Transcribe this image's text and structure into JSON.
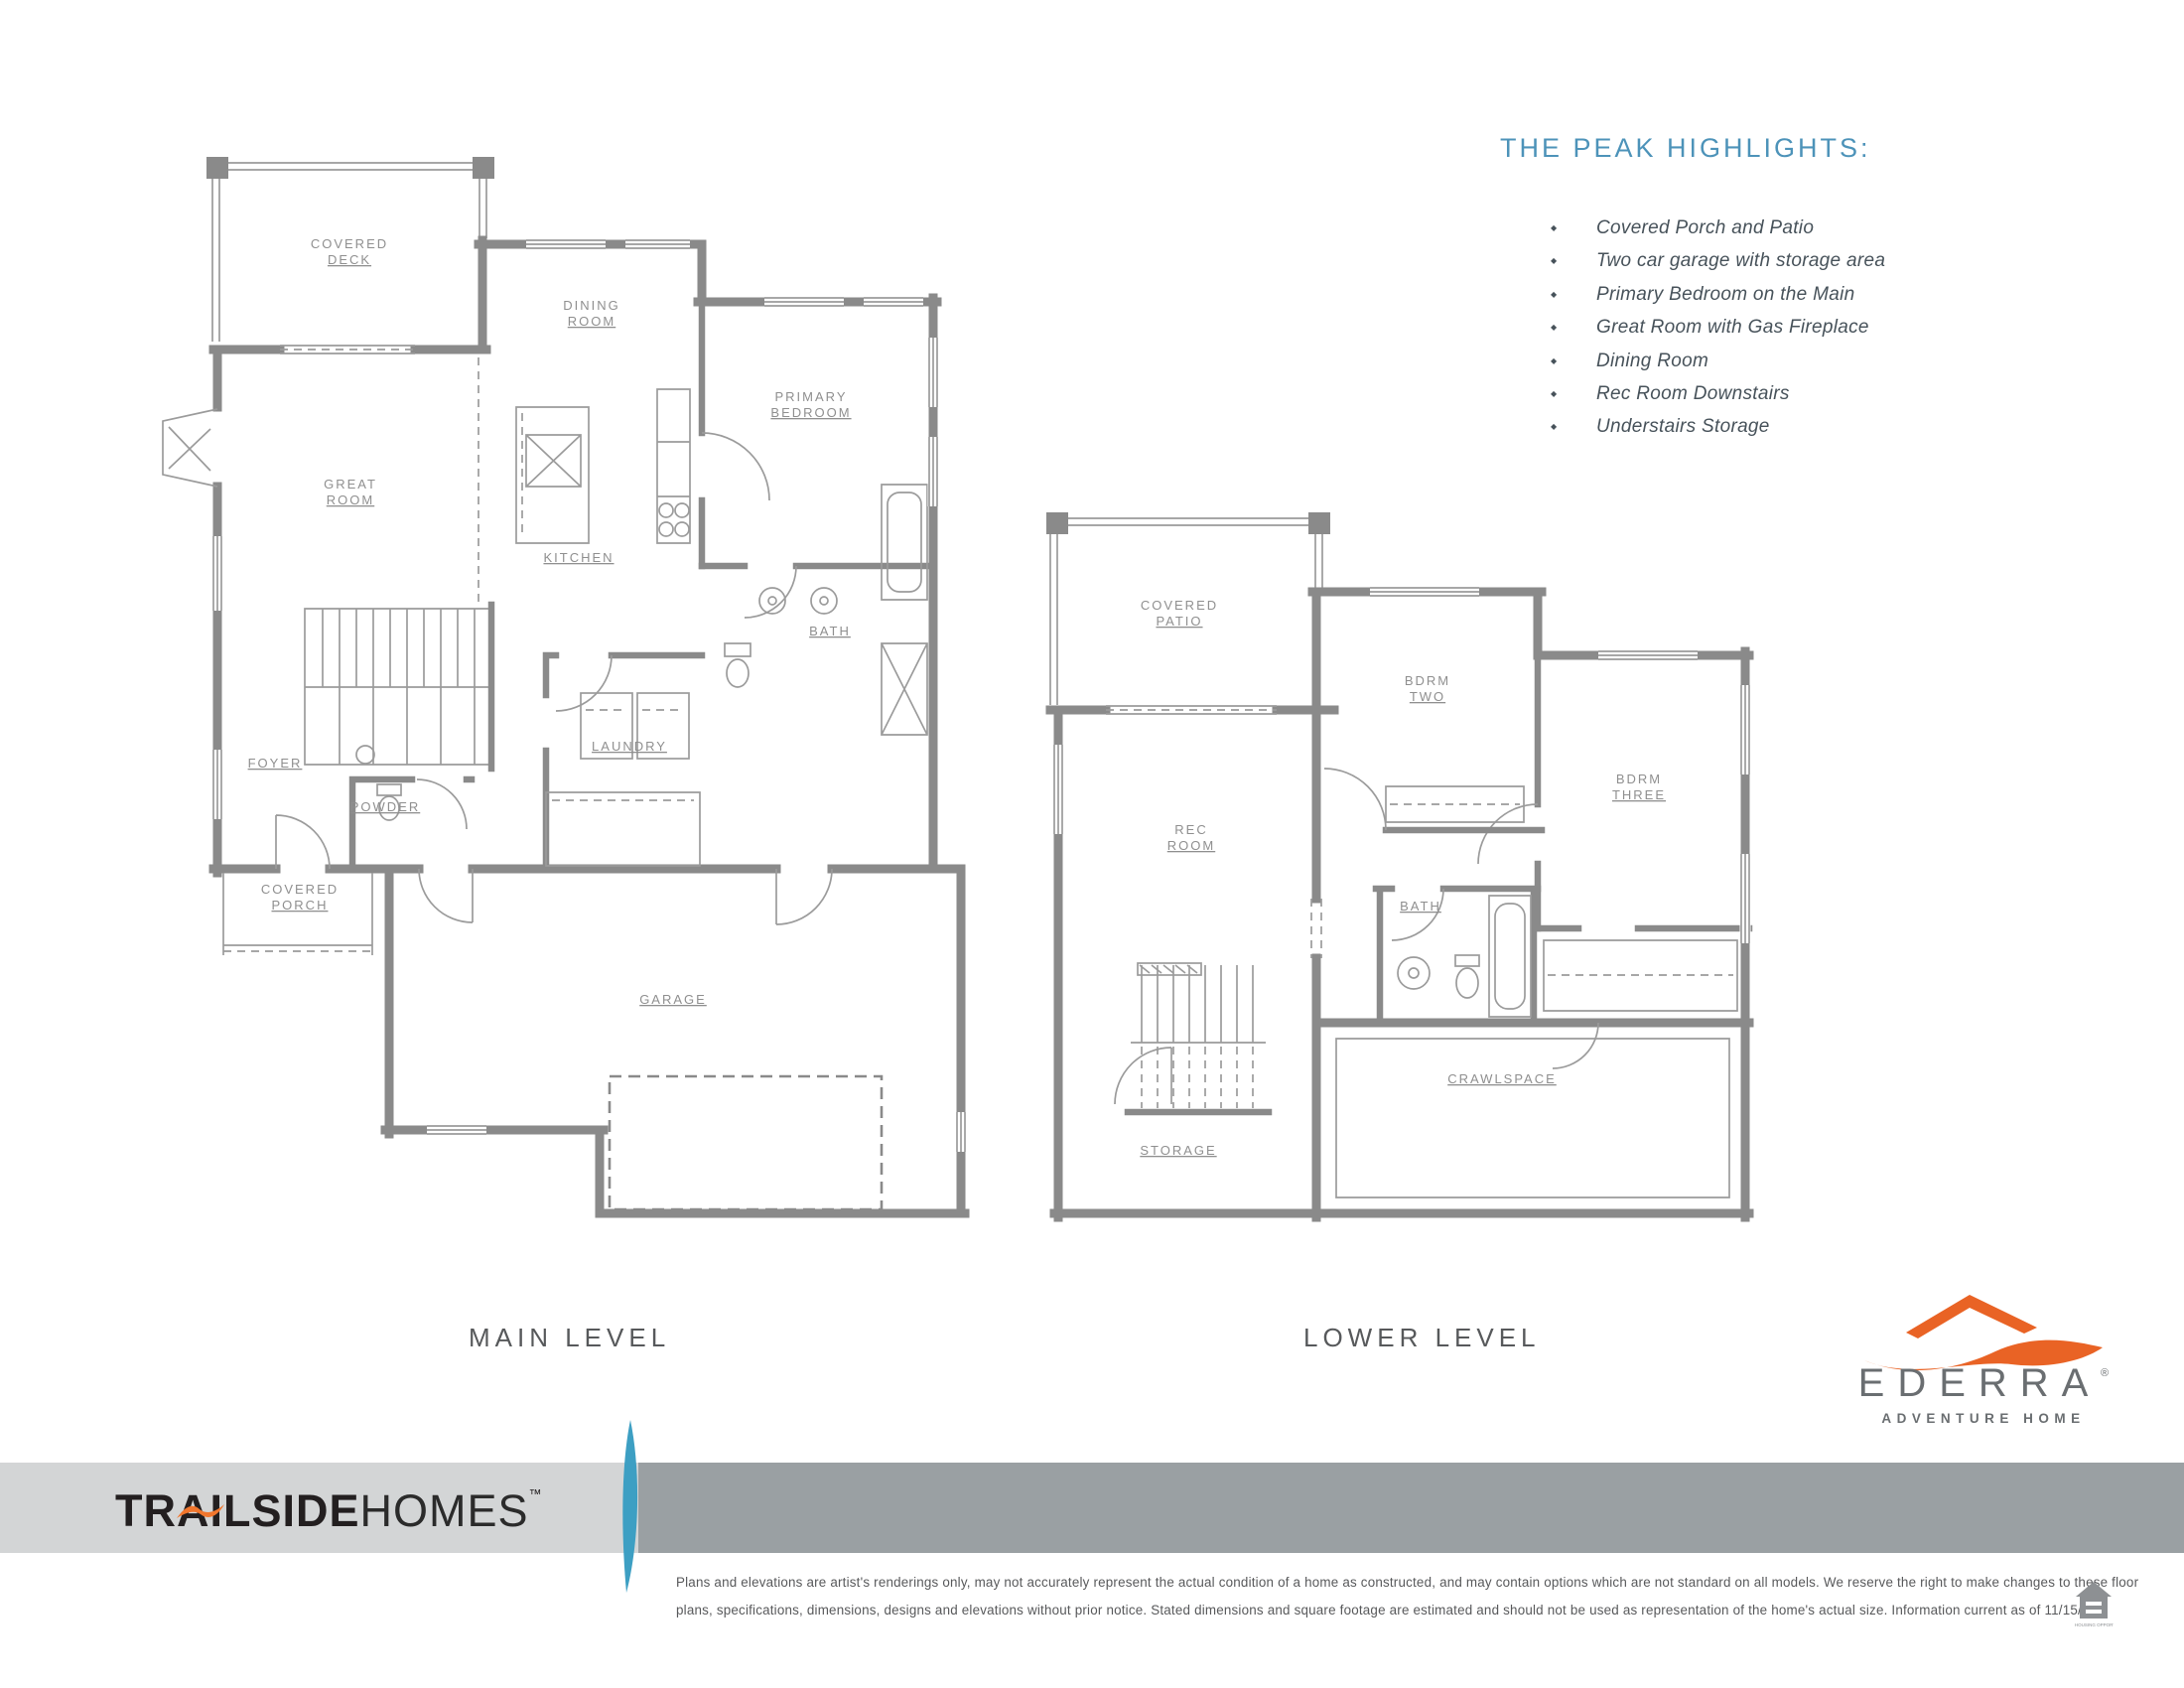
{
  "highlights": {
    "title": "THE PEAK HIGHLIGHTS:",
    "items": [
      "Covered Porch and Patio",
      "Two car garage with storage area",
      "Primary Bedroom on the Main",
      "Great Room with Gas Fireplace",
      "Dining Room",
      "Rec Room Downstairs",
      "Understairs Storage"
    ]
  },
  "plans": {
    "main": {
      "caption": "MAIN LEVEL",
      "rooms": {
        "covered_deck": {
          "line1": "COVERED",
          "line2": "DECK"
        },
        "dining_room": {
          "line1": "DINING",
          "line2": "ROOM"
        },
        "great_room": {
          "line1": "GREAT",
          "line2": "ROOM"
        },
        "kitchen": {
          "line1": "KITCHEN"
        },
        "primary_bedroom": {
          "line1": "PRIMARY",
          "line2": "BEDROOM"
        },
        "bath": {
          "line1": "BATH"
        },
        "laundry": {
          "line1": "LAUNDRY"
        },
        "foyer": {
          "line1": "FOYER"
        },
        "powder": {
          "line1": "POWDER"
        },
        "covered_porch": {
          "line1": "COVERED",
          "line2": "PORCH"
        },
        "garage": {
          "line1": "GARAGE"
        }
      }
    },
    "lower": {
      "caption": "LOWER LEVEL",
      "rooms": {
        "covered_patio": {
          "line1": "COVERED",
          "line2": "PATIO"
        },
        "bdrm_two": {
          "line1": "BDRM",
          "line2": "TWO"
        },
        "rec_room": {
          "line1": "REC",
          "line2": "ROOM"
        },
        "bdrm_three": {
          "line1": "BDRM",
          "line2": "THREE"
        },
        "bath": {
          "line1": "BATH"
        },
        "storage": {
          "line1": "STORAGE"
        },
        "crawlspace": {
          "line1": "CRAWLSPACE"
        }
      }
    }
  },
  "branding": {
    "trailside": {
      "part1": "TRAILSIDE",
      "part2": "HOMES",
      "tm": "™"
    },
    "ederra": {
      "name": "EDERRA",
      "registered": "®",
      "tagline": "ADVENTURE HOME"
    },
    "equal_housing_caption": "EQUAL HOUSING OPPORTUNITY"
  },
  "disclaimer": {
    "line1": "Plans and elevations are artist's renderings only, may not accurately represent the actual condition of a home as constructed, and may contain options which are not standard on all models. We reserve the right to make changes to these floor",
    "line2": "plans, specifications, dimensions, designs and elevations without prior notice. Stated dimensions and square footage are estimated and should not be used as representation of the home's actual size. Information current as of 11/15/24"
  },
  "colors": {
    "highlight_blue": "#4d93b9",
    "plan_gray": "#8a8a8a",
    "accent_orange": "#e96325",
    "bar_light": "#d3d5d6",
    "bar_dark": "#9aa0a3",
    "divider_blue": "#3d9fc3"
  }
}
